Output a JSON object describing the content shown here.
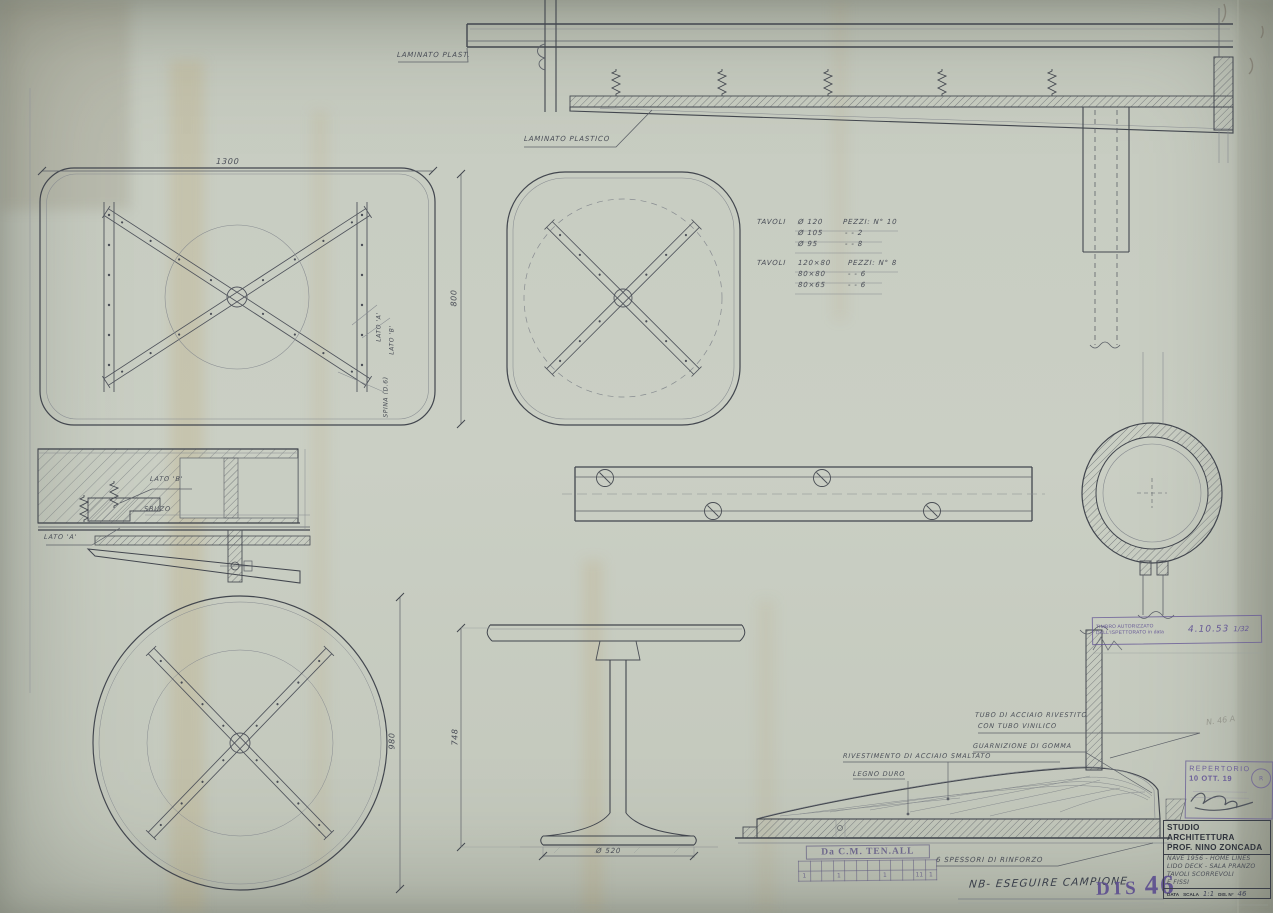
{
  "drawing_labels": {
    "laminato_plast": "LAMINATO PLAST.",
    "laminato_plastico": "LAMINATO PLASTICO",
    "lato_a_rot": "LATO 'A'",
    "lato_b_rot": "LATO 'B'",
    "spina_rot": "SPINA (D.6)",
    "lato_b_section": "LATO 'B'",
    "sbuzo": "SBUZO",
    "lato_a_section": "LATO 'A'",
    "tubo_acciaio_1": "TUBO DI ACCIAIO RIVESTITO",
    "tubo_acciaio_2": "CON TUBO VINILICO",
    "guarnizione": "GUARNIZIONE DI GOMMA",
    "rivestimento": "RIVESTIMENTO DI ACCIAIO SMALTATO",
    "legno_duro": "LEGNO DURO",
    "spessori": "6 SPESSORI DI RINFORZO",
    "nb_note": "NB- ESEGUIRE CAMPIONE"
  },
  "dimensions": {
    "rect_width": "1300",
    "square_height": "800",
    "circle_diameter": "980",
    "table_height": "748",
    "base_diameter": "Ø 520"
  },
  "notes": {
    "block1": [
      [
        "TAVOLI",
        "Ø 120",
        "PEZZI: N° 10"
      ],
      [
        "",
        "Ø 105",
        "-    -    2"
      ],
      [
        "",
        "Ø 95",
        "-    -    8"
      ]
    ],
    "block2": [
      [
        "TAVOLI",
        "120×80",
        "PEZZI: N° 8"
      ],
      [
        "",
        "80×80",
        "-    -    6"
      ],
      [
        "",
        "80×65",
        "-    -    6"
      ]
    ]
  },
  "stamps": {
    "timbro": {
      "text": "TIMBRO AUTORIZZATO DALL'ISPETTORATO in data",
      "date": "4.10.53",
      "sig": "1/32"
    },
    "repertorio": {
      "title": "REPERTORIO",
      "date": "10 OTT. 19",
      "seal": "R"
    },
    "dis": {
      "word": "DIS",
      "number": "46"
    },
    "tenall": {
      "title": "Da C.M. TEN.ALL",
      "marks": [
        "1",
        "",
        "",
        "1",
        "",
        "",
        "",
        "1",
        "",
        "",
        "11",
        "1"
      ]
    },
    "pencil_note": "N. 46 A"
  },
  "title_block": {
    "studio1": "STUDIO ARCHITETTURA",
    "studio2": "PROF. NINO ZONCADA",
    "hw_line1": "NAVE 1956 - HOME LINES",
    "hw_line2": "LIDO DECK - SALA PRANZO",
    "hw_line3": "TAVOLI SCORREVOLI",
    "hw_line4": "E FISSI",
    "data_label": "DATA",
    "scala_label": "SCALA",
    "scala_value": "1:1",
    "dis_label": "DIS. N°",
    "dis_value": "46"
  },
  "colors": {
    "paper": "#c8cdc2",
    "pencil_dark": "#42464e",
    "pencil_mid": "#5d6168",
    "pencil_light": "#878b90",
    "ink_purple": "#665996",
    "print_dark": "#2f333c"
  }
}
